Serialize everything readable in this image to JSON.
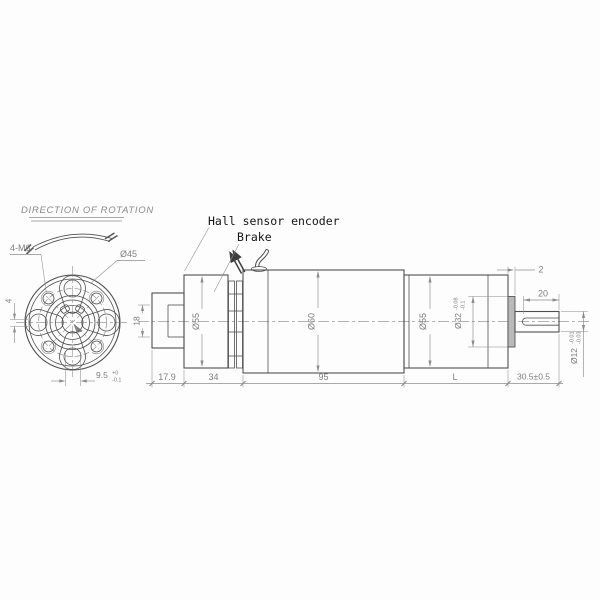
{
  "colors": {
    "line": "#4f4f4f",
    "dim_line": "#8c8c8c",
    "dim_text": "#7f7f7f",
    "label_text": "#141414",
    "boss_fill": "#b9b9b9",
    "background": "#fdfdfd"
  },
  "front_view": {
    "direction_label": "DIRECTION OF ROTATION",
    "bolt_spec": "4-M6",
    "bolt_circle_dia": "Ø45",
    "keyway_width": "4",
    "keyway_depth": "9.5",
    "keyway_depth_tol_up": "+0",
    "keyway_depth_tol_low": "-0.1"
  },
  "side_view": {
    "labels": {
      "encoder": "Hall sensor encoder",
      "brake": "Brake"
    },
    "diameters": {
      "rear_hub": "18",
      "encoder_body": "Ø55",
      "motor_body": "Ø60",
      "gearbox_body": "Ø55",
      "pilot": "Ø32",
      "pilot_tol_up": "-0.08",
      "pilot_tol_low": "-0.1",
      "shaft": "Ø12",
      "shaft_tol_up": "-0.01",
      "shaft_tol_low": "-0.03"
    },
    "lengths": {
      "pilot_boss": "2",
      "shaft_flat": "20",
      "rear": "17.9",
      "encoder_section": "34",
      "motor": "95",
      "gearbox": "L",
      "shaft": "30.5±0.5"
    }
  }
}
